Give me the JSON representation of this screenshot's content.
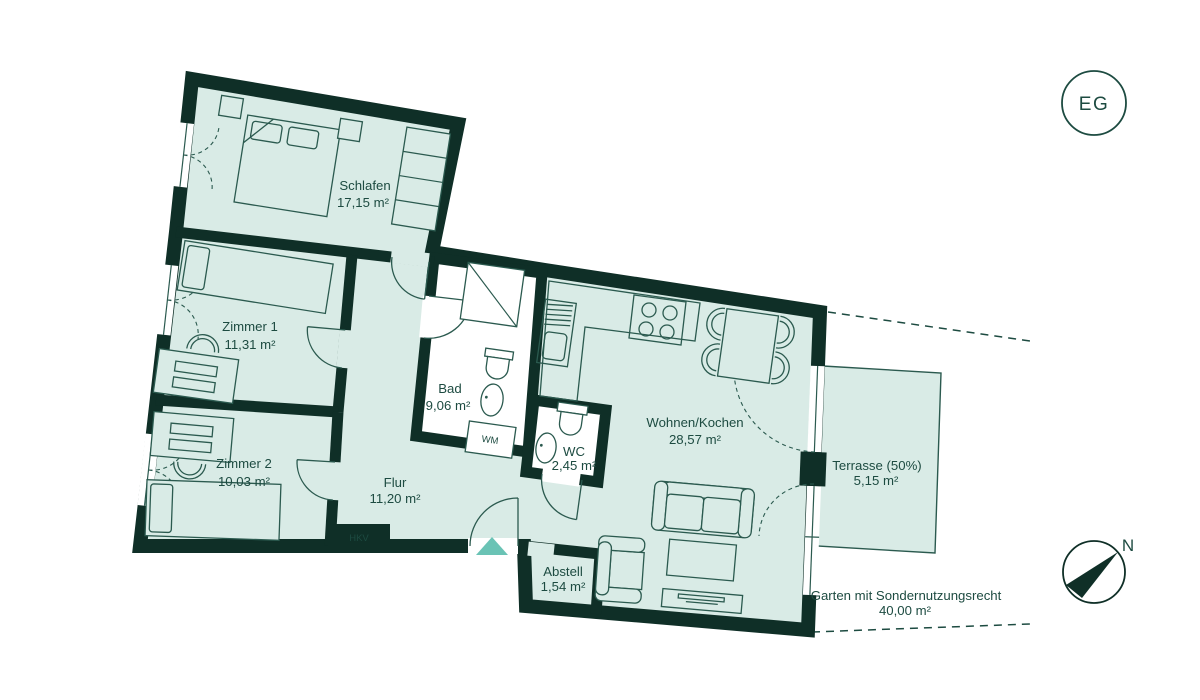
{
  "colors": {
    "wall": "#0f2f27",
    "floor": "#d9ebe6",
    "wet_room_floor": "#ffffff",
    "furniture_line": "#2b5a4f",
    "label_text": "#1d4b41",
    "entrance_arrow": "#6ac3b5"
  },
  "floor_badge": {
    "label": "EG"
  },
  "compass": {
    "north_label": "N"
  },
  "rooms": {
    "schlafen": {
      "name": "Schlafen",
      "area": "17,15 m²"
    },
    "zimmer1": {
      "name": "Zimmer 1",
      "area": "11,31 m²"
    },
    "zimmer2": {
      "name": "Zimmer 2",
      "area": "10,03 m²"
    },
    "bad": {
      "name": "Bad",
      "area": "9,06 m²"
    },
    "wc": {
      "name": "WC",
      "area": "2,45 m²"
    },
    "flur": {
      "name": "Flur",
      "area": "11,20 m²"
    },
    "abstell": {
      "name": "Abstell",
      "area": "1,54 m²"
    },
    "wohnen": {
      "name": "Wohnen/Kochen",
      "area": "28,57 m²"
    },
    "terrasse": {
      "name": "Terrasse (50%)",
      "area": "5,15 m²"
    },
    "garten": {
      "name": "Garten mit Sondernutzungsrecht",
      "area": "40,00 m²"
    }
  },
  "fixtures": {
    "washing_machine_label": "WM",
    "heating_manifold_label": "HKV"
  }
}
